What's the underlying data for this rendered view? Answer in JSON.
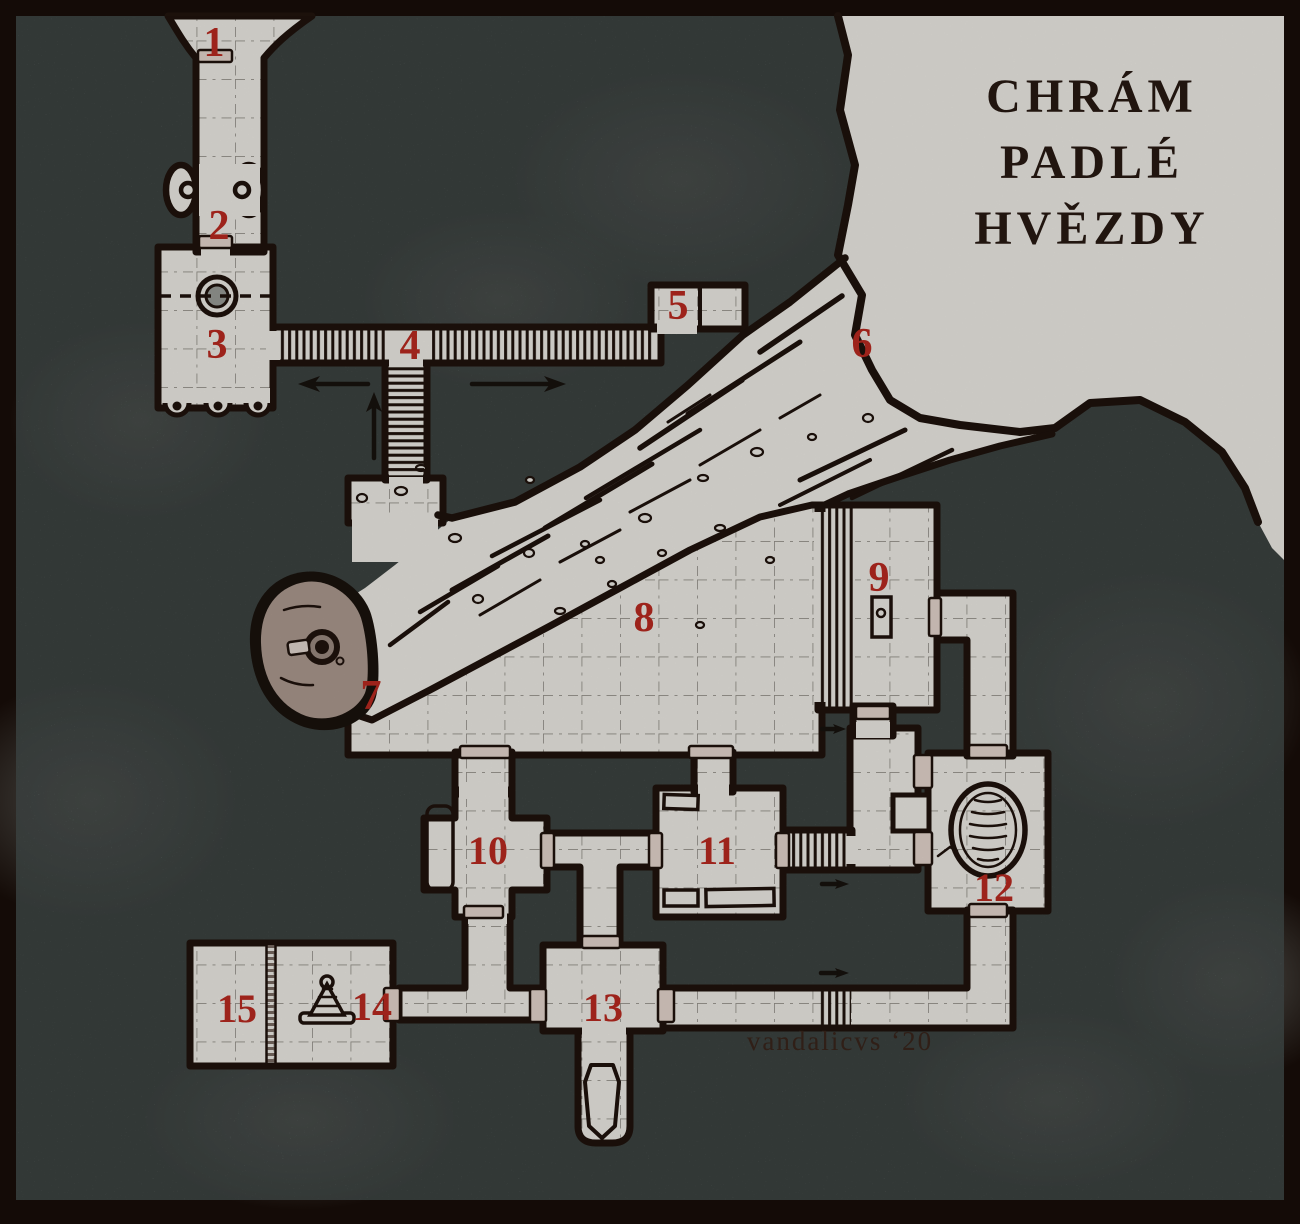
{
  "map": {
    "title_lines": [
      "CHRÁM",
      "PADLÉ",
      "HVĚZDY"
    ],
    "signature": "vandalicvs ‘20",
    "rooms": [
      {
        "number": "1"
      },
      {
        "number": "2"
      },
      {
        "number": "3"
      },
      {
        "number": "4"
      },
      {
        "number": "5"
      },
      {
        "number": "6"
      },
      {
        "number": "7"
      },
      {
        "number": "8"
      },
      {
        "number": "9"
      },
      {
        "number": "10"
      },
      {
        "number": "11"
      },
      {
        "number": "12"
      },
      {
        "number": "13"
      },
      {
        "number": "14"
      },
      {
        "number": "15"
      }
    ],
    "features": {
      "crater": "crater-cavern",
      "impact_trench": "impact-trench",
      "meteorite": "meteorite-icon",
      "well": "well-icon",
      "pool": "oval-pool-icon",
      "cone": "cone-artifact-icon",
      "sarcophagus": "sarcophagus-icon",
      "pedestal": "pedestal-icon",
      "doors": "door-icon",
      "stairs": "stairs-icon",
      "direction_arrows": "direction-arrow-icon"
    },
    "colors": {
      "frame": "#140b07",
      "background": "#5c6562",
      "floor": "#d8d6d0",
      "wall": "#1c110b",
      "room_number": "#a8261d",
      "door": "#cfc2ba",
      "meteorite": "#9c8b82"
    }
  }
}
